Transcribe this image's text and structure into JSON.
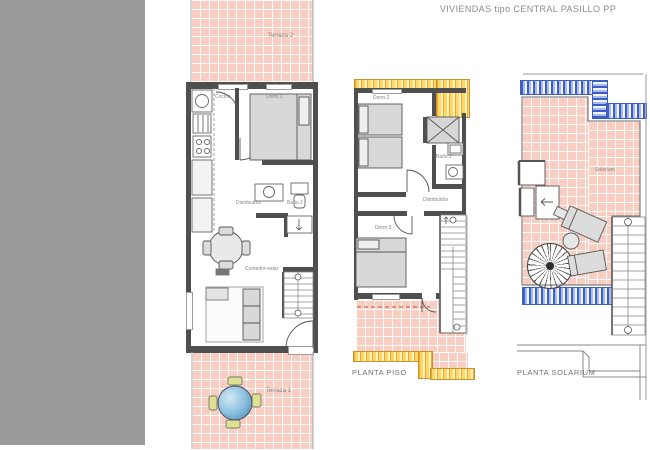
{
  "title": "VIVIENDAS tipo CENTRAL PASILLO PP",
  "plans": {
    "ground": {
      "rooms": {
        "terraza2": "Terraza 2",
        "cocina": "Cocina",
        "dorm1": "Dorm.1",
        "distribuidor": "Distribuidor",
        "bano1": "Baño.1",
        "comedor": "Comedor-estar",
        "terraza1": "Terraza 1"
      }
    },
    "piso": {
      "label": "PLANTA PISO",
      "rooms": {
        "dorm2": "Dorm.2",
        "bano2": "Baño 2",
        "distribuidor": "Distribuidor",
        "dorm3": "Dorm.3"
      }
    },
    "solarium": {
      "label": "PLANTA SOLARIUM",
      "rooms": {
        "solarium": "Solarium"
      }
    }
  },
  "colors": {
    "mask_gray": "#999999",
    "tile_pink": "#f7cec1",
    "hatch_yellow": "#ffd863",
    "hatch_blue": "#3d5ec2",
    "wall": "#4f4f4f",
    "table_blue": "#8cc0de",
    "chair_yellow": "#dde08e",
    "label_gray": "#858585"
  }
}
